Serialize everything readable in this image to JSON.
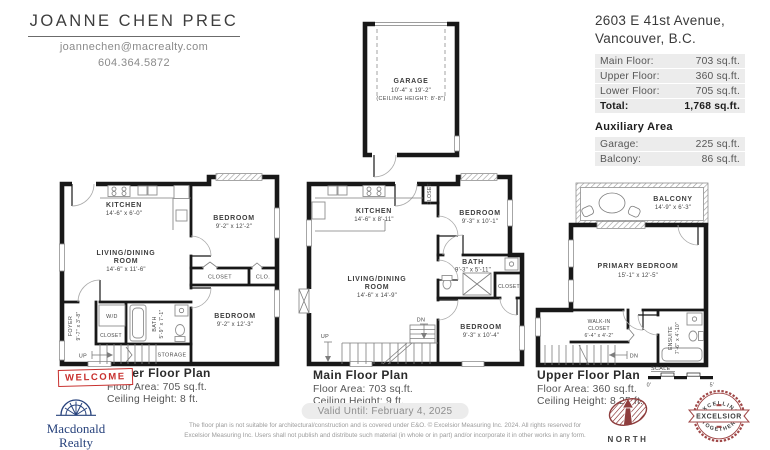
{
  "agent": {
    "name": "JOANNE CHEN PREC",
    "email": "joannechen@macrealty.com",
    "phone": "604.364.5872"
  },
  "property": {
    "address_line1": "2603 E 41st Avenue,",
    "address_line2": "Vancouver, B.C.",
    "areas": [
      {
        "label": "Main Floor:",
        "value": "703 sq.ft."
      },
      {
        "label": "Upper Floor:",
        "value": "360 sq.ft."
      },
      {
        "label": "Lower Floor:",
        "value": "705 sq.ft."
      }
    ],
    "total": {
      "label": "Total:",
      "value": "1,768 sq.ft."
    },
    "aux_heading": "Auxiliary Area",
    "aux": [
      {
        "label": "Garage:",
        "value": "225 sq.ft."
      },
      {
        "label": "Balcony:",
        "value": "86 sq.ft."
      }
    ]
  },
  "garage": {
    "name": "GARAGE",
    "dims": "10'-4\" x 19'-2\"",
    "ceiling": "(CEILING HEIGHT: 8'-8\")"
  },
  "plans": {
    "lower": {
      "title": "Lower Floor Plan",
      "area": "Floor Area: 705 sq.ft.",
      "ceiling": "Ceiling Height: 8 ft.",
      "stamp": "WELCOME",
      "rooms": {
        "kitchen": {
          "name": "KITCHEN",
          "dims": "14'-6\" x 6'-0\""
        },
        "bedroom_top": {
          "name": "BEDROOM",
          "dims": "9'-2\" x 12'-2\""
        },
        "living": {
          "line1": "LIVING/DINING",
          "line2": "ROOM",
          "dims": "14'-6\" x 11'-6\""
        },
        "closet": "CLOSET",
        "clo": "CLO.",
        "foyer": {
          "name": "FOYER",
          "dims": "9'-7\" x 3'-8\""
        },
        "wd": "W/D",
        "closet2": "CLOSET",
        "bath": {
          "name": "BATH",
          "dims": "5'-9\" x 7'-1\""
        },
        "bedroom_bottom": {
          "name": "BEDROOM",
          "dims": "9'-2\" x 12'-3\""
        },
        "storage": "STORAGE",
        "up": "UP"
      }
    },
    "main": {
      "title": "Main Floor Plan",
      "area": "Floor Area: 703 sq.ft.",
      "ceiling": "Ceiling Height: 9 ft.",
      "rooms": {
        "kitchen": {
          "name": "KITCHEN",
          "dims": "14'-6\" x 8'-11\""
        },
        "closet_top": "CLOSET",
        "bedroom_top": {
          "name": "BEDROOM",
          "dims": "9'-3\" x 10'-1\""
        },
        "bath": {
          "name": "BATH",
          "dims": "9'-3\" x 5'-11\""
        },
        "closet_right": "CLOSET",
        "living": {
          "line1": "LIVING/DINING",
          "line2": "ROOM",
          "dims": "14'-6\" x 14'-9\""
        },
        "bedroom_bottom": {
          "name": "BEDROOM",
          "dims": "9'-3\" x 10'-4\""
        },
        "up": "UP",
        "dn": "DN"
      }
    },
    "upper": {
      "title": "Upper Floor Plan",
      "area": "Floor Area: 360 sq.ft.",
      "ceiling": "Ceiling Height: 8.25 ft.",
      "rooms": {
        "balcony": {
          "name": "BALCONY",
          "dims": "14'-9\" x 6'-3\""
        },
        "primary": {
          "name": "PRIMARY BEDROOM",
          "dims": "15'-1\" x 12'-5\""
        },
        "walkin": {
          "line1": "WALK-IN",
          "line2": "CLOSET",
          "dims": "6'-4\" x 4'-2\""
        },
        "ensuite": {
          "name": "ENSUITE",
          "dims": "7'-6\" x 4'-10\""
        },
        "dn": "DN"
      }
    }
  },
  "scale": {
    "label": "SCALE",
    "start": "0'",
    "end": "5'"
  },
  "footer": {
    "valid": "Valid Until: February 4, 2025",
    "line1": "The floor plan is not suitable for architectural/construction and is covered under E&O. © Excelsior Measuring Inc. 2024. All rights reserved for",
    "line2": "Excelsior Measuring Inc. Users shall not publish and distribute such material (in whole or in part) and/or incorporate it in other works in any form."
  },
  "logos": {
    "macdonald": {
      "line1": "Macdonald",
      "line2": "Realty"
    },
    "north": {
      "label": "NORTH"
    },
    "excelsior": {
      "top": "EXCELLING",
      "banner": "EXCELSIOR",
      "bottom": "TOGETHER"
    }
  },
  "colors": {
    "stamp_red": "#c8302e",
    "seal_red": "#a04848",
    "north_red": "#8e3d3d",
    "navy": "#27427c",
    "panel_gray": "#ececec"
  }
}
